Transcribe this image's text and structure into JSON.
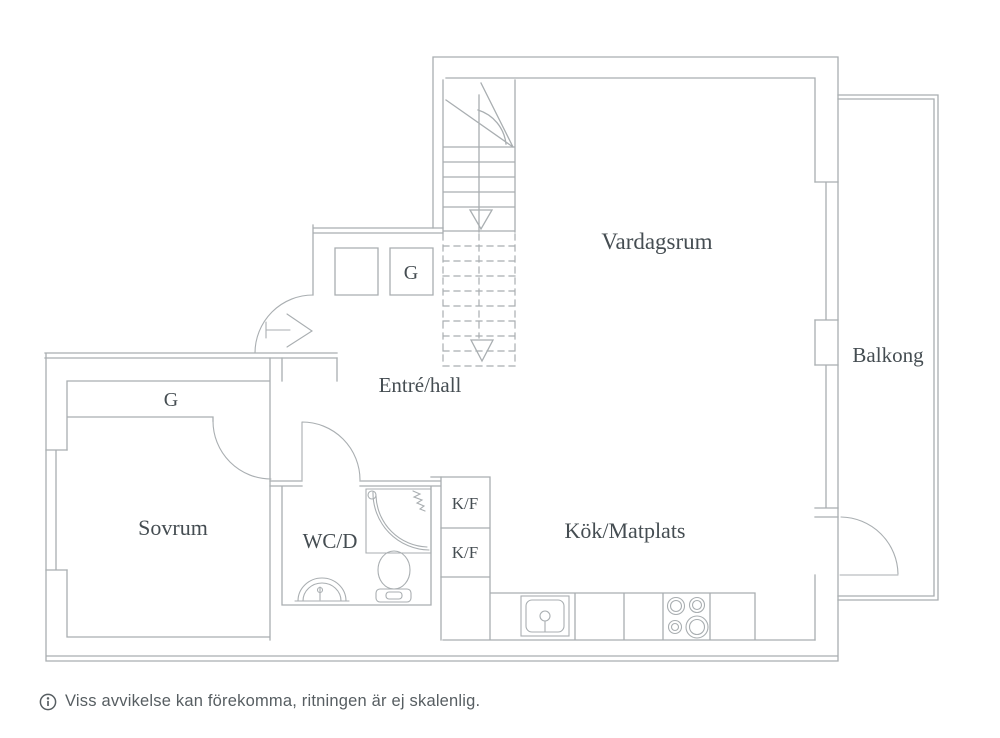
{
  "floor_plan": {
    "rooms": {
      "vardagsrum": "Vardagsrum",
      "balkong": "Balkong",
      "entre_hall": "Entré/hall",
      "sovrum": "Sovrum",
      "wcd": "WC/D",
      "kok_matplats": "Kök/Matplats"
    },
    "closets": {
      "hall_closet": "G",
      "bedroom_closet": "G",
      "fridge_upper": "K/F",
      "fridge_lower": "K/F"
    },
    "footer": {
      "disclaimer": "Viss avvikelse kan förekomma, ritningen är ej skalenlig."
    },
    "colors": {
      "wall_line": "#a9aeb1",
      "label_text": "#454d52",
      "footer_text": "#575e62",
      "background": "#ffffff"
    }
  }
}
